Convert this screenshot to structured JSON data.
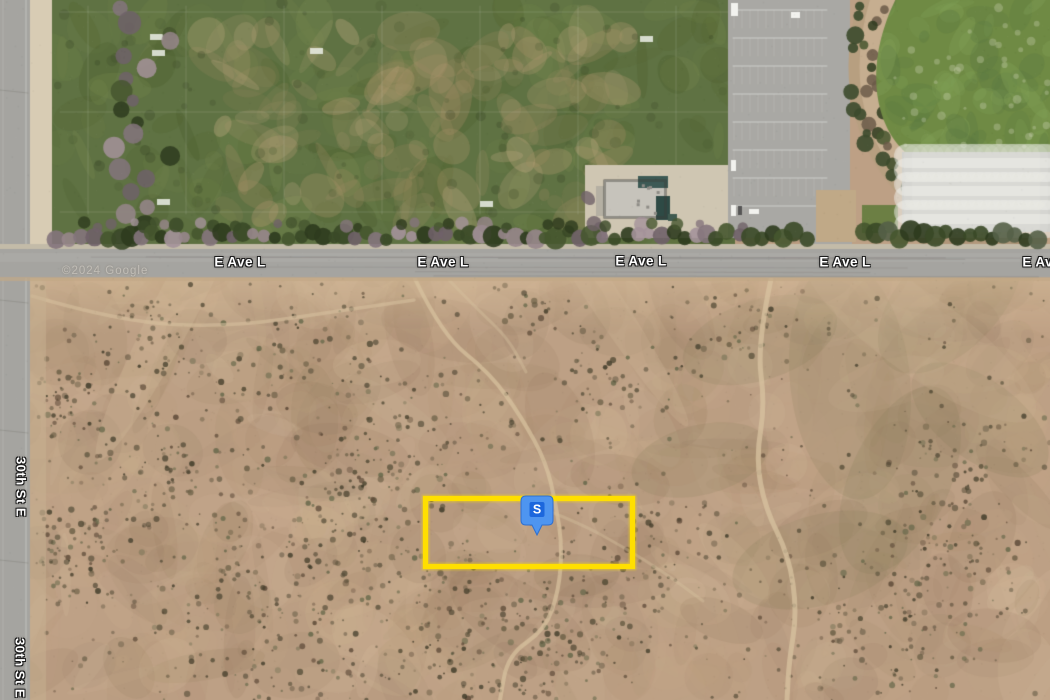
{
  "map": {
    "type": "satellite",
    "attribution": "©2024 Google",
    "attribution_pos": {
      "x": 62,
      "y": 271
    },
    "roads": {
      "horizontal": {
        "name": "E Ave L",
        "labels": [
          {
            "x": 240,
            "y": 262
          },
          {
            "x": 443,
            "y": 262
          },
          {
            "x": 641,
            "y": 261
          },
          {
            "x": 845,
            "y": 262
          },
          {
            "x": 1048,
            "y": 262
          }
        ]
      },
      "vertical": {
        "name": "30th St E",
        "labels": [
          {
            "x": 21,
            "y": 487
          },
          {
            "x": 20,
            "y": 668
          }
        ]
      }
    },
    "marker": {
      "label": "S",
      "x": 537,
      "y": 538,
      "body_color": "#4e95f0",
      "inner_color": "#1c67dd",
      "text_color": "#ffffff"
    },
    "parcel": {
      "x": 423,
      "y": 496,
      "width": 212,
      "height": 73,
      "border_width": 5,
      "border_color": "#ffdf00"
    },
    "colors": {
      "desert_base": "#bda085",
      "desert_light": [
        "#d6bd9a",
        "#cbb08c",
        "#e0cba9",
        "#c8ab8a"
      ],
      "desert_dark": [
        "#9c8164",
        "#8d7254",
        "#a98b6c",
        "#8a6f58"
      ],
      "desert_olive": "#7c774f",
      "desert_red": "#8d6a58",
      "bush": [
        "#554d38",
        "#463f2c",
        "#6b5f46",
        "#3f3b29",
        "#5d4a38",
        "#66684a"
      ],
      "trail": "#d8c3a0",
      "park_base": "#5f7243",
      "park_green": [
        "#6e8149",
        "#53652f",
        "#77884e",
        "#4c5e2d"
      ],
      "park_tan": [
        "#b59c74",
        "#c9b088",
        "#a38d64"
      ],
      "tree_green": [
        "#3a4927",
        "#2e3b1e",
        "#46562f"
      ],
      "tree_purple": [
        "#84747c",
        "#97868b",
        "#6f6168",
        "#a4929a"
      ],
      "asphalt": "#a5a4a0",
      "curb": "#c3bba8",
      "sidewalk": "#d8ccb4",
      "lot": "#a9a8a4",
      "stall": "rgba(240,240,235,0.5)",
      "grass_base": "#6f8a44",
      "grass_light": "#81a057",
      "grass_dark": "#597741",
      "grass_speck": "#d8dcc0",
      "strip": "#b79f80",
      "strip_light": "#c9b293",
      "roof": "#c6c3bb",
      "roof_wing": "#b5b0a3",
      "teal": "#3d5a55",
      "teal_dark": "#2e4a45",
      "apron": "#cfc6b2",
      "shoulder": "#c2a886"
    }
  }
}
